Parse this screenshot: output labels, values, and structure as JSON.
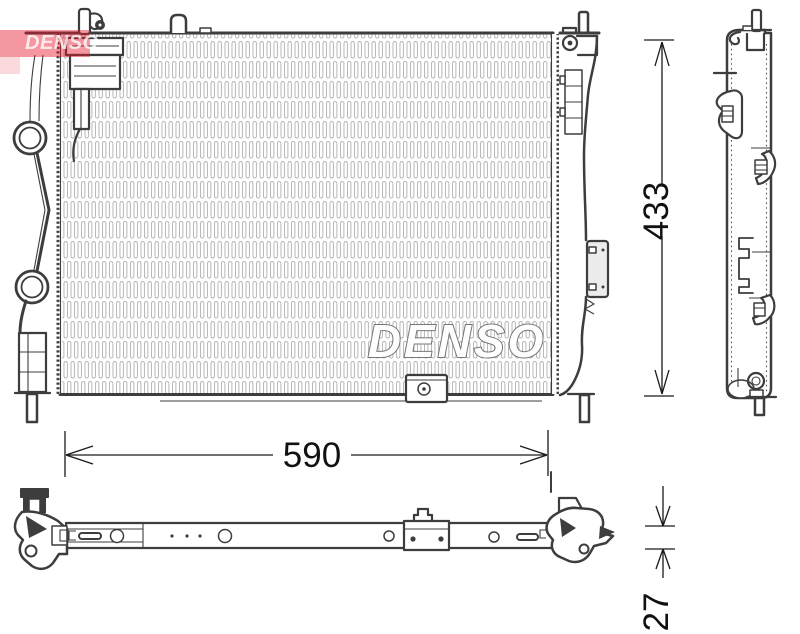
{
  "product": {
    "brand": "DENSO",
    "center_watermark": "DENSO",
    "corner_logo_text": "DENSO"
  },
  "dimensions": {
    "width_mm": "590",
    "height_mm": "433",
    "depth_mm": "27"
  },
  "colors": {
    "background": "#ffffff",
    "line": "#3d3d3d",
    "fin_stroke": "#b0b0b0",
    "dimension_text": "#111111",
    "logo_red": "#e8192c",
    "watermark_fill": "#ffffff",
    "watermark_outline": "#707070",
    "bracket_plate_fill": "#ececec"
  }
}
